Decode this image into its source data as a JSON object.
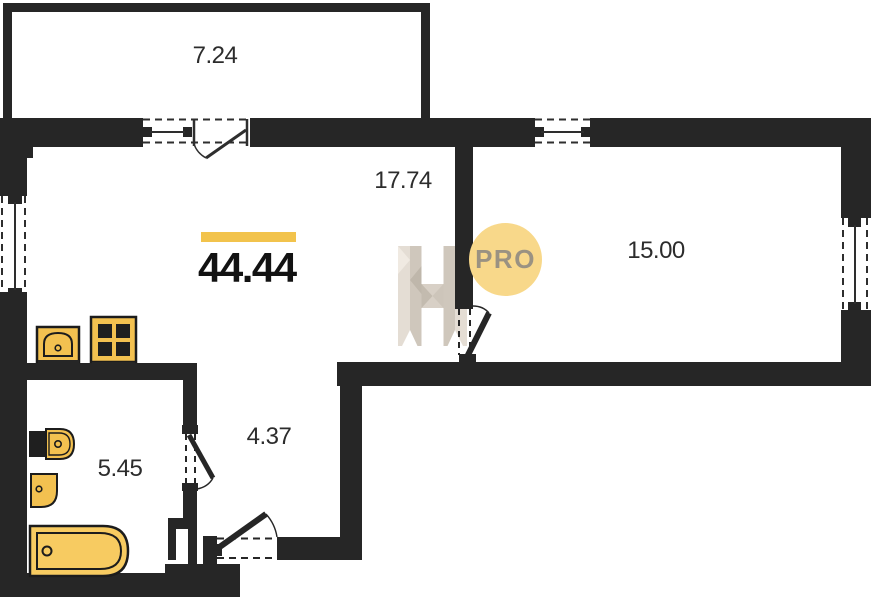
{
  "badge": {
    "label": "PRO"
  },
  "total": {
    "area": "44.44"
  },
  "rooms": {
    "balcony": {
      "area": "7.24"
    },
    "living": {
      "area": "17.74"
    },
    "bedroom": {
      "area": "15.00"
    },
    "hallway": {
      "area": "4.37"
    },
    "bathroom": {
      "area": "5.45"
    }
  },
  "colors": {
    "wall": "#262626",
    "accent_bar": "#f2c34c",
    "badge_fill": "#f8d88a",
    "badge_text": "#9a9282",
    "fixture_fill": "#f3c150",
    "bathtub_fill": "#f7cb61",
    "watermark_light": "#e4ddd4",
    "watermark_dark": "#cfc7bc"
  }
}
